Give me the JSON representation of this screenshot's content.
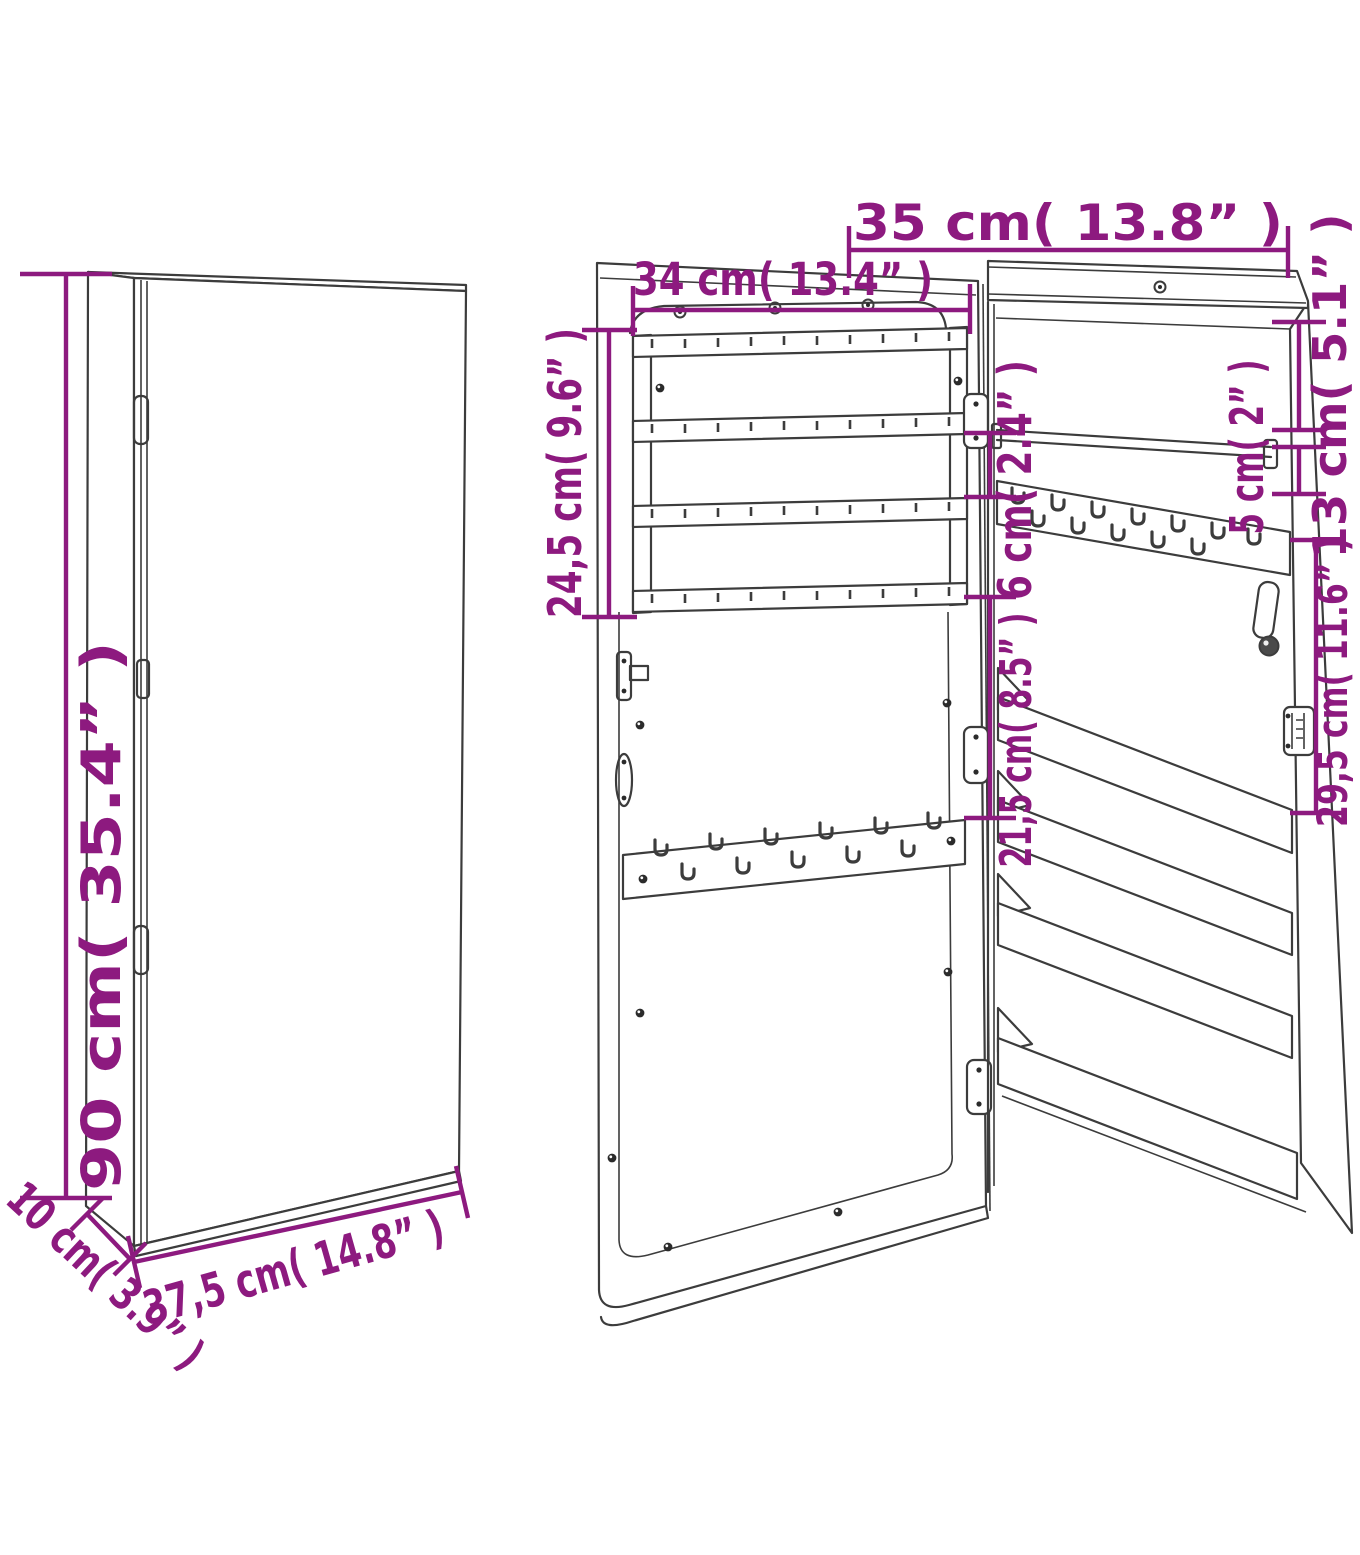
{
  "diagram": {
    "kind": "furniture dimension line drawing",
    "subject": "wall mounted mirror jewellery cabinet",
    "accent_color": "#8d1a7f",
    "line_color": "#3c3c3c",
    "background": "#ffffff",
    "views": {
      "closed": {
        "title": "closed cabinet view",
        "dimensions": {
          "height": {
            "cm": 90,
            "in": 35.4,
            "label": "90 cm( 35.4” )"
          },
          "width": {
            "cm": 37.5,
            "in": 14.8,
            "label": "37,5 cm( 14.8” )"
          },
          "depth": {
            "cm": 10,
            "in": 3.9,
            "label": "10 cm( 3.9” )"
          }
        },
        "features": {
          "hinges": 2,
          "door_gap": true
        }
      },
      "door": {
        "title": "open door inside view",
        "dimensions": {
          "organizer_width": {
            "cm": 34,
            "in": 13.4,
            "label": "34 cm( 13.4” )"
          },
          "organizer_height": {
            "cm": 24.5,
            "in": 9.6,
            "label": "24,5 cm( 9.6” )"
          },
          "rod_gap": {
            "cm": 6,
            "in": 2.4,
            "label": "6 cm( 2.4” )"
          },
          "hook_rail_drop": {
            "cm": 21.5,
            "in": 8.5,
            "label": "21,5 cm( 8.5” )"
          }
        },
        "features": {
          "earring_rails": 4,
          "hook_rail_hooks": 11,
          "keyhole_hangers": 3,
          "hinges": 3
        }
      },
      "cabinet": {
        "title": "cabinet interior view",
        "dimensions": {
          "width": {
            "cm": 35,
            "in": 13.8,
            "label": "35 cm( 13.8” )"
          },
          "top_to_rod": {
            "cm": 13,
            "in": 5.1,
            "label": "13 cm( 5.1” )"
          },
          "rod_to_rail": {
            "cm": 5,
            "in": 2,
            "label": "5 cm( 2” )"
          },
          "rail_to_shelf": {
            "cm": 29.5,
            "in": 11.6,
            "label": "29,5 cm( 11.6” )"
          }
        },
        "features": {
          "shelves": 3,
          "bottom_board": 1,
          "hanging_rod": 1,
          "hook_rail_hooks": 12,
          "keyhole_hangers": 1,
          "lock_hanger": true,
          "latch": true
        }
      }
    }
  }
}
